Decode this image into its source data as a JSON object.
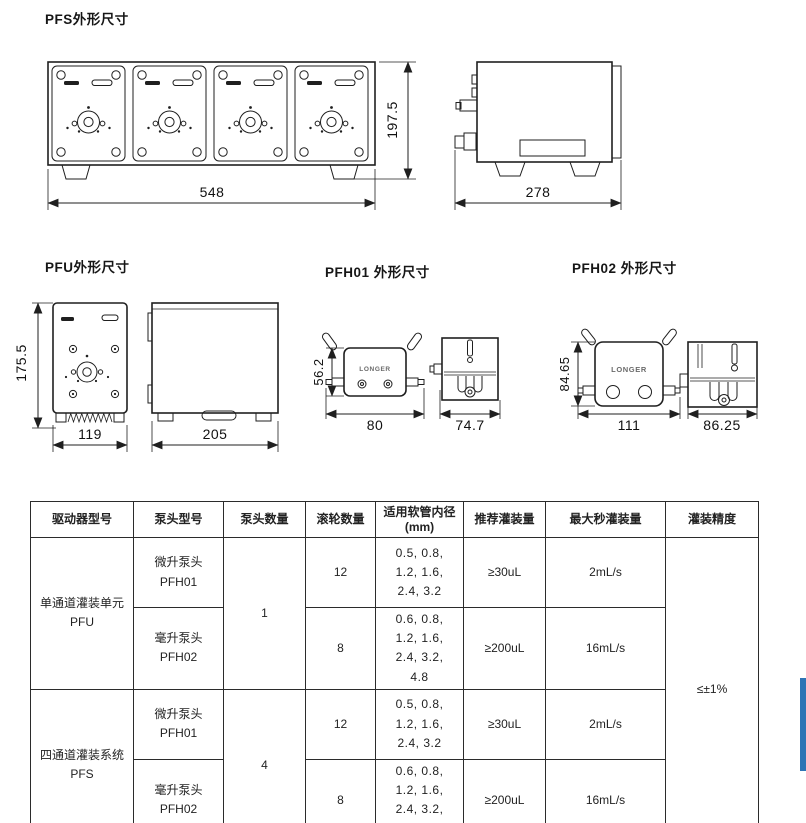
{
  "sections": {
    "pfs": {
      "title": "PFS外形尺寸",
      "front_width": "548",
      "front_height": "197.5",
      "side_depth": "278"
    },
    "pfu": {
      "title": "PFU外形尺寸",
      "front_height": "175.5",
      "front_width": "119",
      "side_depth": "205"
    },
    "pfh01": {
      "title": "PFH01 外形尺寸",
      "logo": "LONGER",
      "front_height": "56.2",
      "front_width": "80",
      "side_depth": "74.7"
    },
    "pfh02": {
      "title": "PFH02 外形尺寸",
      "logo": "LONGER",
      "front_height": "84.65",
      "front_width": "111",
      "side_depth": "86.25"
    }
  },
  "table": {
    "headers": [
      "驱动器型号",
      "泵头型号",
      "泵头数量",
      "滚轮数量",
      "适用软管内径\n(mm)",
      "推荐灌装量",
      "最大秒灌装量",
      "灌装精度"
    ],
    "groups": [
      {
        "driver": "单通道灌装单元\nPFU",
        "pump_heads": "1",
        "rows": [
          {
            "head": "微升泵头\nPFH01",
            "rollers": "12",
            "tubing_id": "0.5, 0.8,\n1.2, 1.6,\n2.4, 3.2",
            "recommended_fill": "≥30uL",
            "max_fill_per_sec": "2mL/s"
          },
          {
            "head": "毫升泵头\nPFH02",
            "rollers": "8",
            "tubing_id": "0.6, 0.8,\n1.2, 1.6,\n2.4, 3.2,\n4.8",
            "recommended_fill": "≥200uL",
            "max_fill_per_sec": "16mL/s"
          }
        ]
      },
      {
        "driver": "四通道灌装系统\nPFS",
        "pump_heads": "4",
        "rows": [
          {
            "head": "微升泵头\nPFH01",
            "rollers": "12",
            "tubing_id": "0.5, 0.8,\n1.2, 1.6,\n2.4, 3.2",
            "recommended_fill": "≥30uL",
            "max_fill_per_sec": "2mL/s"
          },
          {
            "head": "毫升泵头\nPFH02",
            "rollers": "8",
            "tubing_id": "0.6, 0.8,\n1.2, 1.6,\n2.4, 3.2,\n4.8",
            "recommended_fill": "≥200uL",
            "max_fill_per_sec": "16mL/s"
          }
        ]
      }
    ],
    "filling_accuracy": "≤±1%"
  },
  "scrollbar": {
    "color": "#2e74b5",
    "thumb_style": "background:#2e74b5"
  }
}
